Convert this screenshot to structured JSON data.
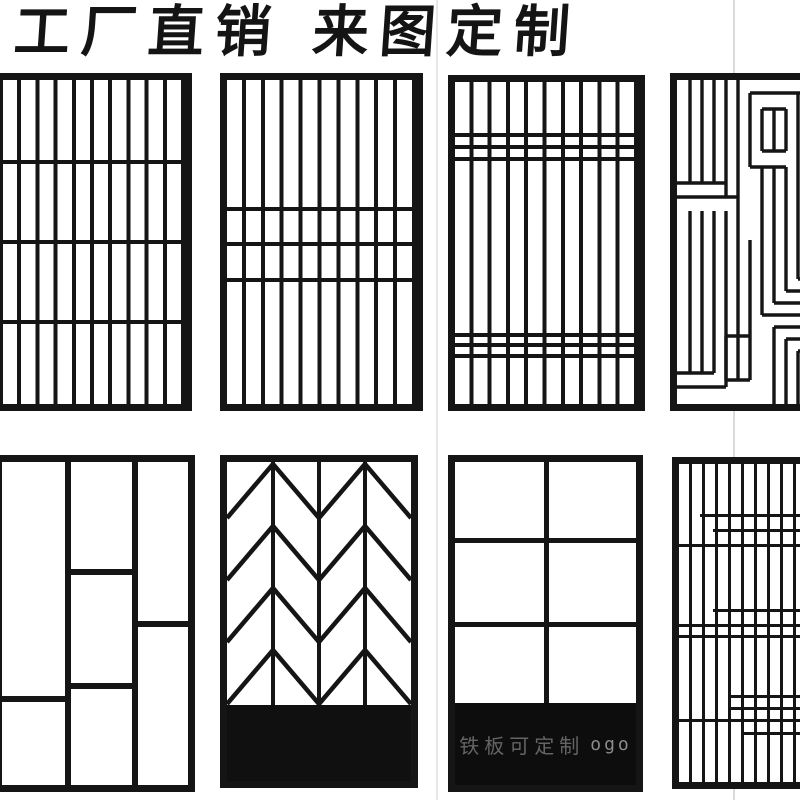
{
  "header": {
    "title": "工厂直销 来图定制"
  },
  "colors": {
    "ink": "#151515",
    "background": "#ffffff",
    "black_band": "#0d0d0d",
    "watermark_text": "#646464",
    "faint_guide_line": "#dadada"
  },
  "panels": [
    {
      "id": 1,
      "pattern": "vertical-slat-grid",
      "cols": 10,
      "rows": 4
    },
    {
      "id": 2,
      "pattern": "vertical-slats-center-band",
      "cols": 10,
      "band_lines": 3
    },
    {
      "id": 3,
      "pattern": "vertical-slats-top-bottom-bands",
      "cols": 10,
      "band_lines": 6
    },
    {
      "id": 4,
      "pattern": "greek-key-maze",
      "note": "cut off at right edge"
    },
    {
      "id": 5,
      "pattern": "offset-rectangles",
      "cols": 3,
      "note": "cut off at left edge"
    },
    {
      "id": 6,
      "pattern": "herringbone-chevron",
      "cols": 4,
      "zigzag_rows": 4,
      "base": "solid-black"
    },
    {
      "id": 7,
      "pattern": "six-pane-grid",
      "cols": 2,
      "rows": 3,
      "base": "solid-black",
      "watermark": "铁板可定制",
      "watermark_suffix": "ogo"
    },
    {
      "id": 8,
      "pattern": "dense-lattice",
      "note": "cut off at right edge"
    }
  ]
}
